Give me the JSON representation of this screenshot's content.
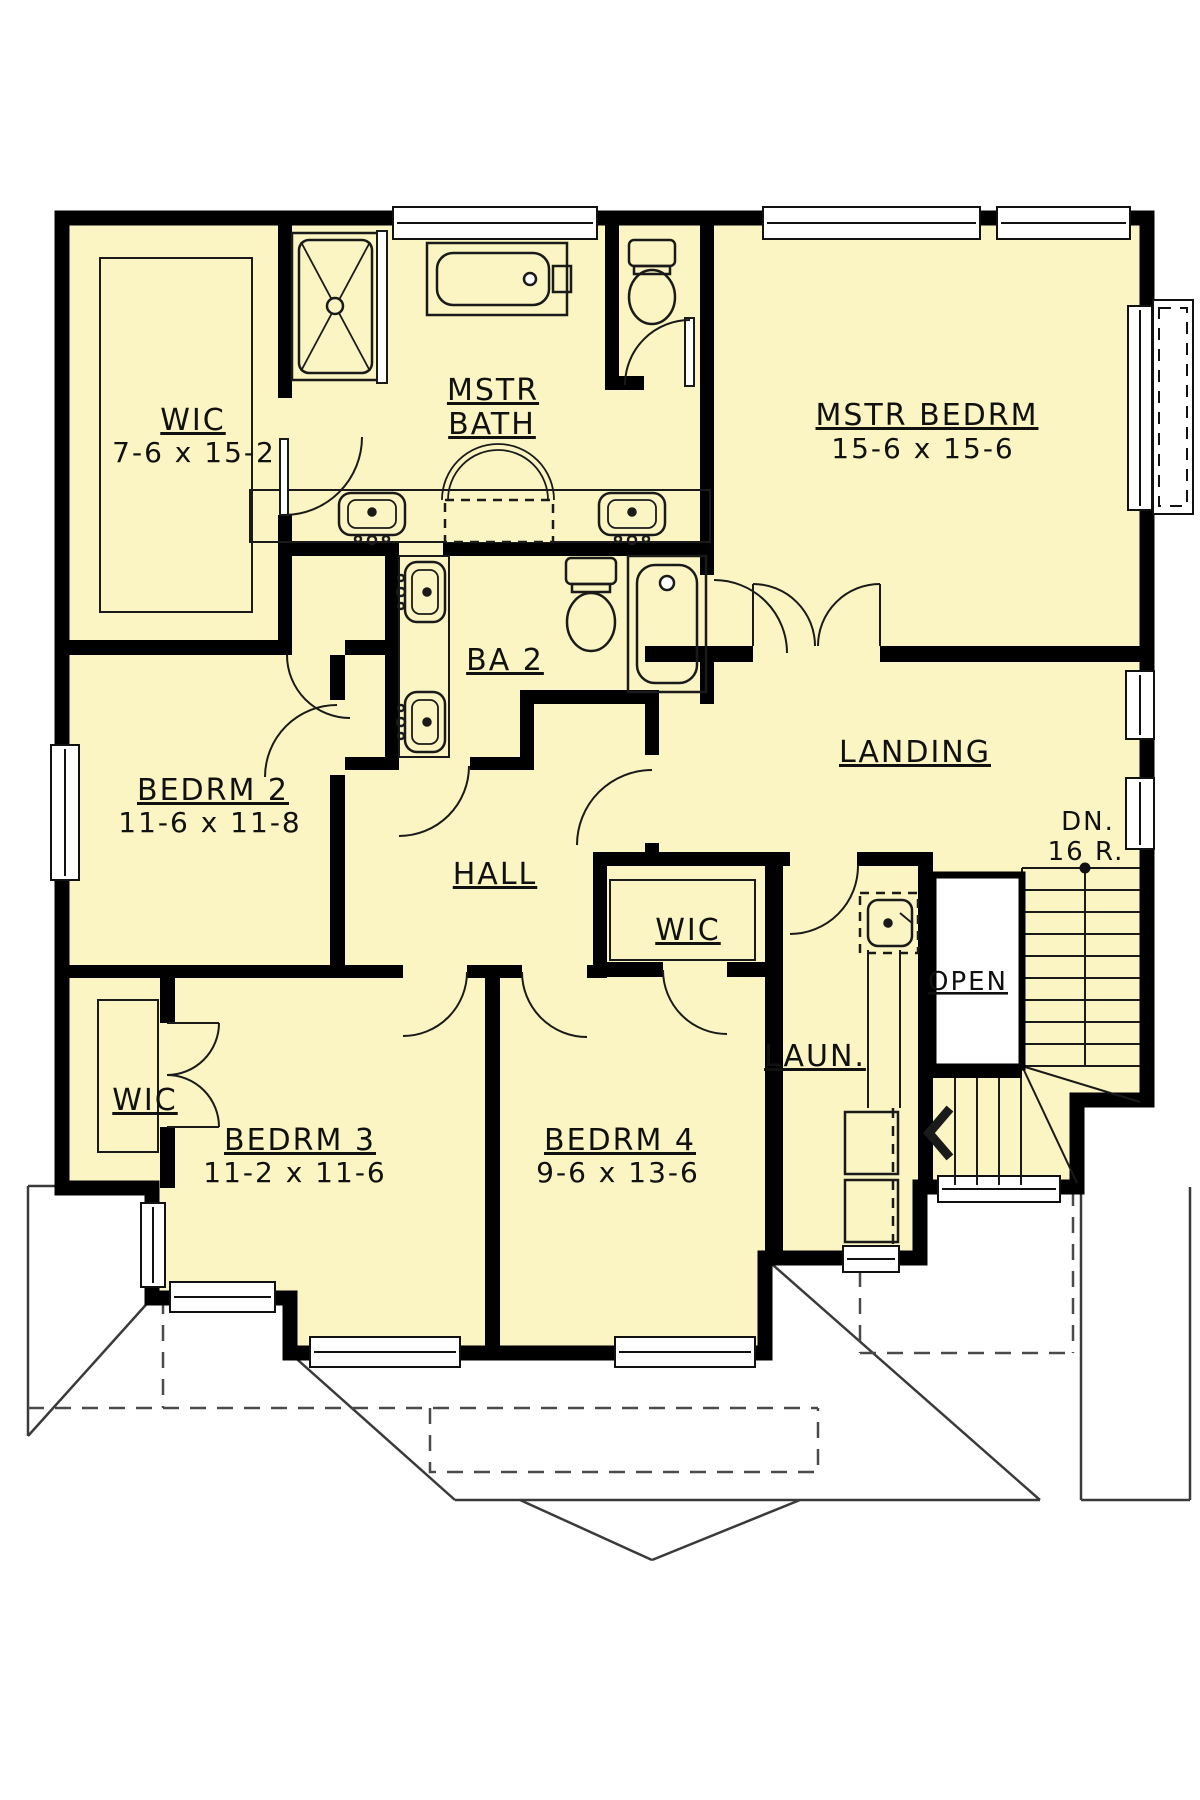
{
  "colors": {
    "floor": "#FAF5C2",
    "wall": "#000000",
    "fixture_line": "#1a1a1a",
    "roof_line": "#3a3a3a",
    "background": "#ffffff"
  },
  "rooms": {
    "master_wic": {
      "name": "WIC",
      "dims": "7-6 x 15-2"
    },
    "master_bath": {
      "name_line1": "MSTR",
      "name_line2": "BATH"
    },
    "master_bedroom": {
      "name": "MSTR BEDRM",
      "dims": "15-6 x 15-6"
    },
    "bath2": {
      "name": "BA 2"
    },
    "landing": {
      "name": "LANDING"
    },
    "bedroom2": {
      "name": "BEDRM 2",
      "dims": "11-6 x 11-8"
    },
    "hall": {
      "name": "HALL"
    },
    "hall_wic": {
      "name": "WIC"
    },
    "laundry": {
      "name": "LAUN."
    },
    "bedroom3_wic": {
      "name": "WIC"
    },
    "bedroom3": {
      "name": "BEDRM 3",
      "dims": "11-2 x 11-6"
    },
    "bedroom4": {
      "name": "BEDRM 4",
      "dims": "9-6 x 13-6"
    }
  },
  "stairs": {
    "open_label": "OPEN",
    "down_abbr": "DN.",
    "riser_count": "16 R."
  }
}
